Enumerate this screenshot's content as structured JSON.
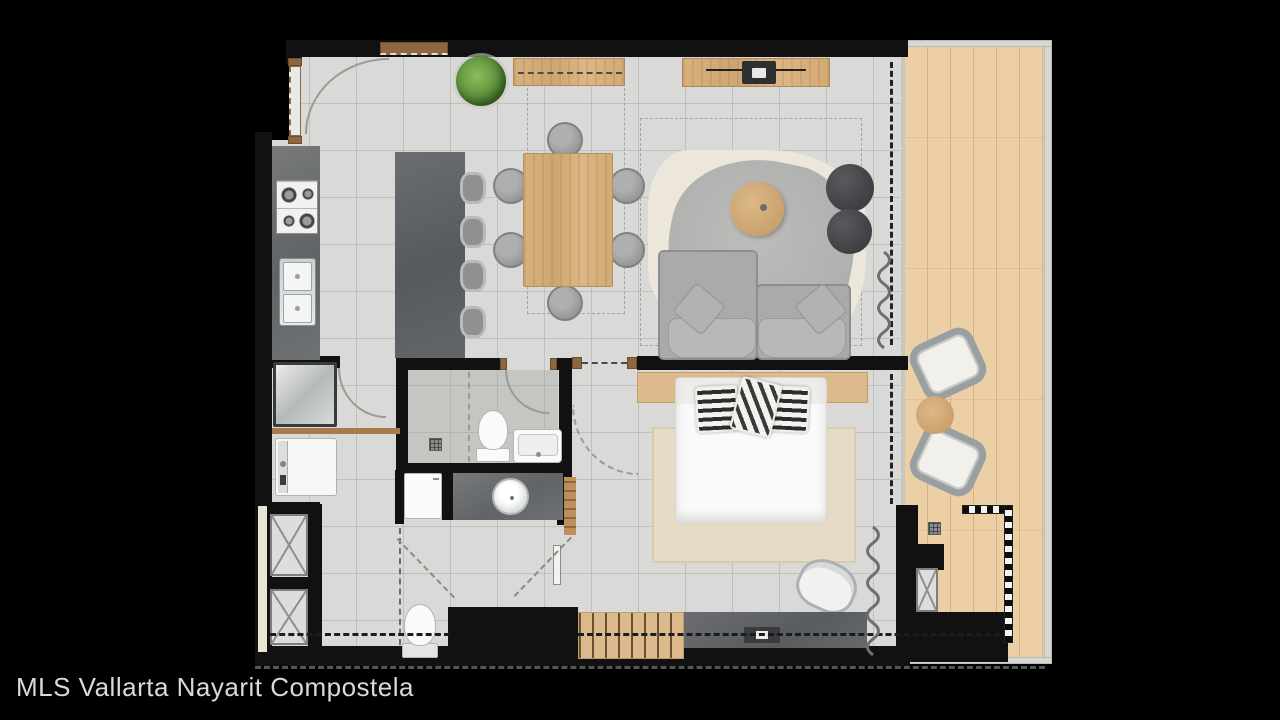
{
  "caption": "MLS Vallarta Nayarit Compostela",
  "palette": {
    "background": "#000000",
    "wall": "#111111",
    "floor_tile": "#d9d9d7",
    "balcony_wood": "#eccfa4",
    "wood_accent": "#d3ab77",
    "counter_dark": "#6e7072",
    "fixture_white": "#f9fafa",
    "sofa_gray": "#a9aaa9",
    "rug_cream": "#ece7da",
    "rug_beige": "#e6dcc6",
    "plant_green": "#6a9c43",
    "caption_text": "#d9d9d9"
  },
  "plan": {
    "type": "apartment-floor-plan",
    "rooms": [
      "kitchen",
      "dining",
      "living",
      "bedroom",
      "bathroom",
      "laundry-hall",
      "storage-closets",
      "balcony"
    ],
    "fixtures": [
      "stove",
      "double-sink",
      "kitchen-island",
      "bar-stools",
      "refrigerator",
      "washer",
      "dining-table",
      "dining-chairs",
      "tv-console",
      "tv",
      "area-rug",
      "coffee-table",
      "poufs",
      "sofa",
      "bed",
      "headboard",
      "bedroom-rug",
      "accent-chair",
      "clothes-rack",
      "dresser",
      "toilet",
      "vanity-basin",
      "shower",
      "bathtub-sink",
      "balcony-chairs",
      "balcony-table",
      "planter-grille",
      "curtains",
      "potted-plant"
    ]
  }
}
